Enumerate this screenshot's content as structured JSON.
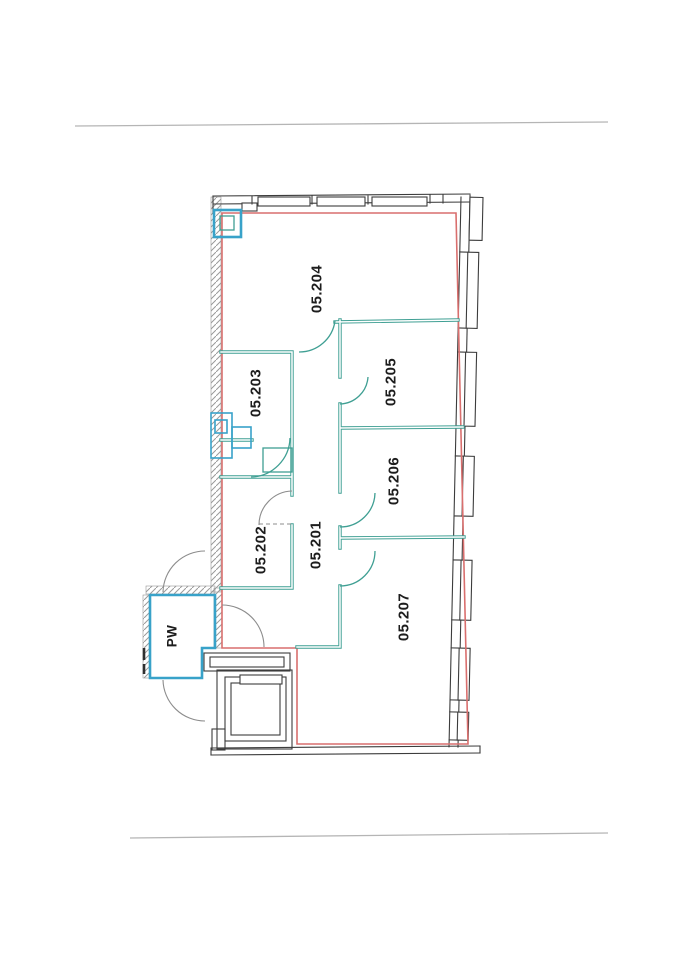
{
  "figure": {
    "kind": "scanned floor plan",
    "rooms": {
      "r204": {
        "label": "05.204"
      },
      "r203": {
        "label": "05.203"
      },
      "r205": {
        "label": "05.205"
      },
      "r206": {
        "label": "05.206"
      },
      "r202": {
        "label": "05.202"
      },
      "r201": {
        "label": "05.201"
      },
      "r207": {
        "label": "05.207"
      },
      "pw": {
        "label": "PW"
      }
    }
  },
  "colors": {
    "boundary_red": "#d96f6e",
    "partition_teal": "#3f9f93",
    "fixture_blue": "#38a2c9",
    "wall_outline": "#3c3c3c",
    "hatch_gray": "#9a9a9a",
    "page_rule": "#b5b5b5"
  }
}
